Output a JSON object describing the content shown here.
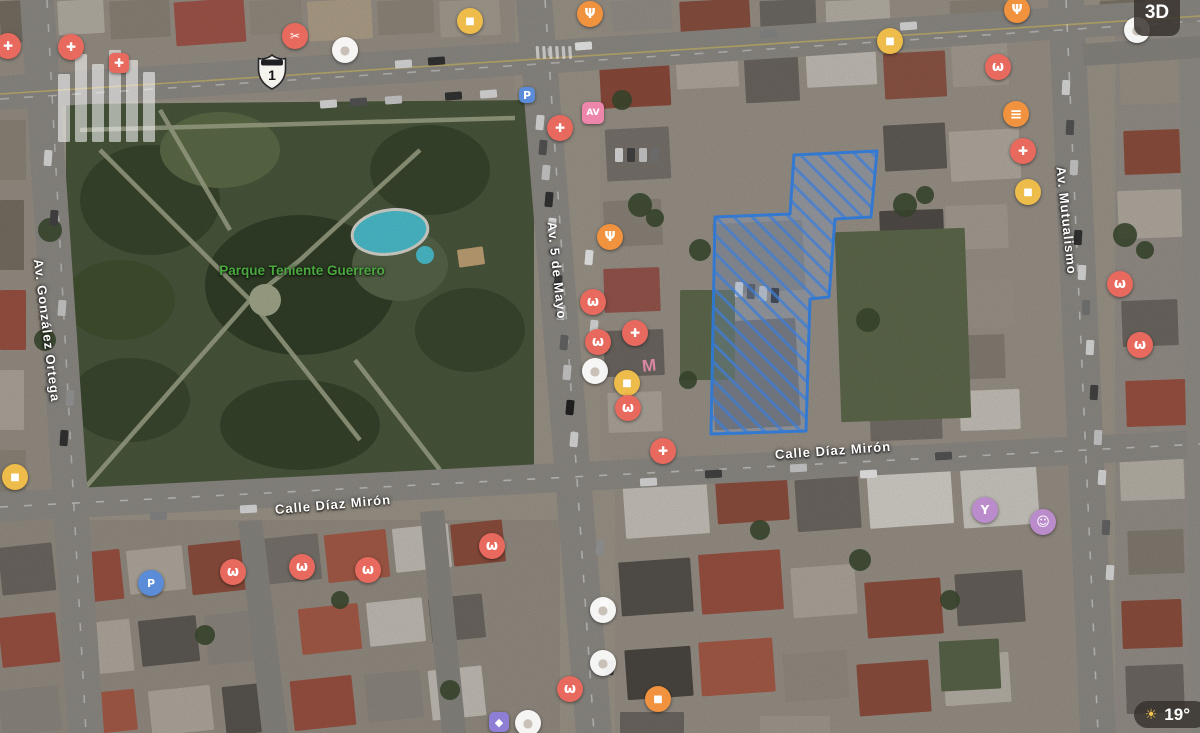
{
  "map": {
    "park_label": "Parque Teniente Guerrero",
    "park_label_color": "#4aa83f",
    "rooftop_sign": "M",
    "route_shield": {
      "number": "1"
    },
    "streets": [
      {
        "name": "Av. González Ortega",
        "cx": 47,
        "cy": 332,
        "rotation": 83,
        "width": 150
      },
      {
        "name": "Av. 5 de Mayo",
        "cx": 557,
        "cy": 272,
        "rotation": 84,
        "width": 120
      },
      {
        "name": "Av. Mutualismo",
        "cx": 1066,
        "cy": 222,
        "rotation": 84,
        "width": 135
      },
      {
        "name": "Calle Díaz Mirón",
        "cx": 833,
        "cy": 452,
        "rotation": -4,
        "width": 130
      },
      {
        "name": "Calle Díaz Mirón",
        "cx": 333,
        "cy": 506,
        "rotation": -5,
        "width": 130
      }
    ],
    "parcel": {
      "points": "715,217 790,214 794,155 877,151 871,217 835,219 829,297 810,299 806,431 711,434",
      "stroke": "#2f79d6",
      "hatch_color": "rgba(62,126,214,0.8)",
      "fill": "rgba(130,175,240,0.22)"
    }
  },
  "controls": {
    "mode_3d_label": "3D",
    "temperature": "19°",
    "weather_icon": "sun"
  },
  "poi_colors": {
    "red": "#e8695e",
    "orange": "#f0923e",
    "yellow": "#eebc4a",
    "purple": "#bb8ccc",
    "violet": "#8f7fd4",
    "blue": "#5b8cd8",
    "pink": "#ee86ac"
  },
  "poi_markers": [
    {
      "x": 8,
      "y": 46,
      "color": "#e8695e",
      "glyph": "✚",
      "category": "medical"
    },
    {
      "x": 71,
      "y": 47,
      "color": "#e8695e",
      "glyph": "✚",
      "category": "medical"
    },
    {
      "x": 119,
      "y": 63,
      "color": "#e8695e",
      "glyph": "✚",
      "category": "hospital",
      "shape": "sq",
      "size": 20
    },
    {
      "x": 295,
      "y": 36,
      "color": "#e8695e",
      "glyph": "✂",
      "category": "salon"
    },
    {
      "x": 345,
      "y": 50,
      "color": "faded",
      "glyph": "●",
      "category": "generic"
    },
    {
      "x": 470,
      "y": 21,
      "color": "#eebc4a",
      "glyph": "■",
      "category": "shopping"
    },
    {
      "x": 590,
      "y": 14,
      "color": "#f0923e",
      "glyph": "Ψ",
      "category": "restaurant"
    },
    {
      "x": 890,
      "y": 41,
      "color": "#eebc4a",
      "glyph": "■",
      "category": "shopping"
    },
    {
      "x": 1017,
      "y": 10,
      "color": "#f0923e",
      "glyph": "Ψ",
      "category": "restaurant"
    },
    {
      "x": 1137,
      "y": 30,
      "color": "faded",
      "glyph": "●",
      "category": "generic"
    },
    {
      "x": 998,
      "y": 67,
      "color": "#e8695e",
      "glyph": "ω",
      "category": "dentist"
    },
    {
      "x": 1016,
      "y": 114,
      "color": "#f0923e",
      "glyph": "≡",
      "category": "food"
    },
    {
      "x": 1023,
      "y": 151,
      "color": "#e8695e",
      "glyph": "✚",
      "category": "medical"
    },
    {
      "x": 1028,
      "y": 192,
      "color": "#eebc4a",
      "glyph": "■",
      "category": "shopping"
    },
    {
      "x": 1120,
      "y": 284,
      "color": "#e8695e",
      "glyph": "ω",
      "category": "dentist"
    },
    {
      "x": 1140,
      "y": 345,
      "color": "#e8695e",
      "glyph": "ω",
      "category": "dentist"
    },
    {
      "x": 527,
      "y": 95,
      "color": "#5b8cd8",
      "glyph": "P",
      "category": "parking",
      "shape": "sq",
      "size": 16
    },
    {
      "x": 560,
      "y": 128,
      "color": "#e8695e",
      "glyph": "✚",
      "category": "medical"
    },
    {
      "x": 593,
      "y": 113,
      "color": "#ee86ac",
      "glyph": "AV",
      "category": "store",
      "shape": "sq",
      "size": 22
    },
    {
      "x": 610,
      "y": 237,
      "color": "#f0923e",
      "glyph": "Ψ",
      "category": "restaurant"
    },
    {
      "x": 593,
      "y": 302,
      "color": "#e8695e",
      "glyph": "ω",
      "category": "dentist"
    },
    {
      "x": 635,
      "y": 333,
      "color": "#e8695e",
      "glyph": "✚",
      "category": "medical"
    },
    {
      "x": 598,
      "y": 342,
      "color": "#e8695e",
      "glyph": "ω",
      "category": "dentist"
    },
    {
      "x": 595,
      "y": 371,
      "color": "faded",
      "glyph": "●",
      "category": "generic"
    },
    {
      "x": 627,
      "y": 383,
      "color": "#eebc4a",
      "glyph": "■",
      "category": "shopping"
    },
    {
      "x": 628,
      "y": 408,
      "color": "#e8695e",
      "glyph": "ω",
      "category": "dentist"
    },
    {
      "x": 663,
      "y": 451,
      "color": "#e8695e",
      "glyph": "✚",
      "category": "medical"
    },
    {
      "x": 15,
      "y": 477,
      "color": "#eebc4a",
      "glyph": "■",
      "category": "shopping"
    },
    {
      "x": 151,
      "y": 583,
      "color": "#5b8cd8",
      "glyph": "P",
      "category": "gas"
    },
    {
      "x": 233,
      "y": 572,
      "color": "#e8695e",
      "glyph": "ω",
      "category": "dentist"
    },
    {
      "x": 302,
      "y": 567,
      "color": "#e8695e",
      "glyph": "ω",
      "category": "dentist"
    },
    {
      "x": 368,
      "y": 570,
      "color": "#e8695e",
      "glyph": "ω",
      "category": "dentist"
    },
    {
      "x": 492,
      "y": 546,
      "color": "#e8695e",
      "glyph": "ω",
      "category": "dentist"
    },
    {
      "x": 570,
      "y": 689,
      "color": "#e8695e",
      "glyph": "ω",
      "category": "dentist"
    },
    {
      "x": 658,
      "y": 699,
      "color": "#f0923e",
      "glyph": "■",
      "category": "shopping"
    },
    {
      "x": 499,
      "y": 722,
      "color": "#8f7fd4",
      "glyph": "◆",
      "category": "services",
      "shape": "sq",
      "size": 20
    },
    {
      "x": 528,
      "y": 723,
      "color": "faded",
      "glyph": "●",
      "category": "generic"
    },
    {
      "x": 985,
      "y": 510,
      "color": "#bb8ccc",
      "glyph": "Y",
      "category": "trophy"
    },
    {
      "x": 1043,
      "y": 522,
      "color": "#bb8ccc",
      "glyph": "☺",
      "category": "theater"
    },
    {
      "x": 603,
      "y": 610,
      "color": "faded",
      "glyph": "●",
      "category": "generic"
    },
    {
      "x": 603,
      "y": 663,
      "color": "faded",
      "glyph": "●",
      "category": "generic"
    }
  ]
}
